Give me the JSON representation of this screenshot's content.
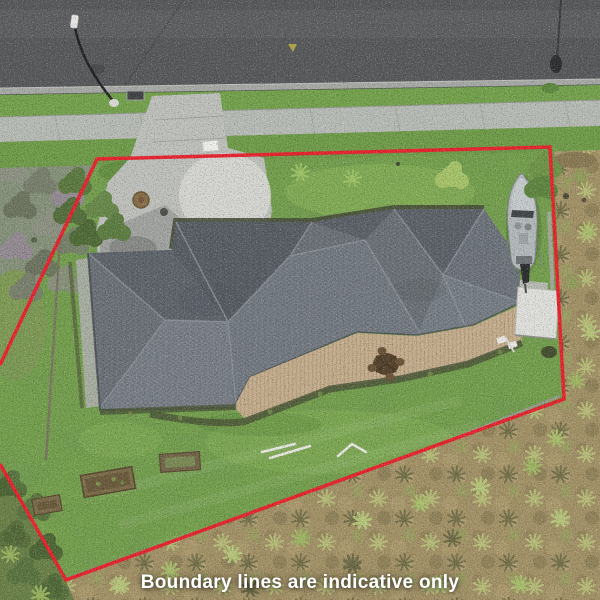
{
  "caption": {
    "text": "Boundary lines are indicative only"
  },
  "overlay": {
    "boundary_style": "solid red outline",
    "boundary_shape": "irregular five-sided lot"
  },
  "colors": {
    "boundary_red": "#e8232e",
    "caption_white": "#ffffff",
    "road_asphalt": "#58595b",
    "gutter_concrete": "#a7aaa6",
    "footpath_concrete": "#b8bcb6",
    "verge_green": "#74a24c",
    "lawn_green": "#75a14d",
    "frontage_green": "#6f9c49",
    "driveway_concrete": "#bfc1bd",
    "roof_shingle_gray": "#6d7379",
    "deck_timber": "#c4ad8d",
    "scrub_olive": "#a39267",
    "neighbour_bush_gray": "#86927b"
  },
  "scene": {
    "view": "top-down aerial drone photo of residential property",
    "objects": [
      "asphalt road",
      "street light",
      "power pole",
      "concrete kerb and gutter",
      "grass verge",
      "concrete footpath",
      "concrete driveway",
      "white marker at boundary",
      "grey hipped shingle roof house",
      "timber deck with outdoor table and chairs",
      "aluminium boat parked beside house",
      "white flat-roof structure",
      "lawn with raised garden beds",
      "red property boundary outline",
      "neighbouring scrub lot",
      "neighbouring shrubs"
    ]
  }
}
